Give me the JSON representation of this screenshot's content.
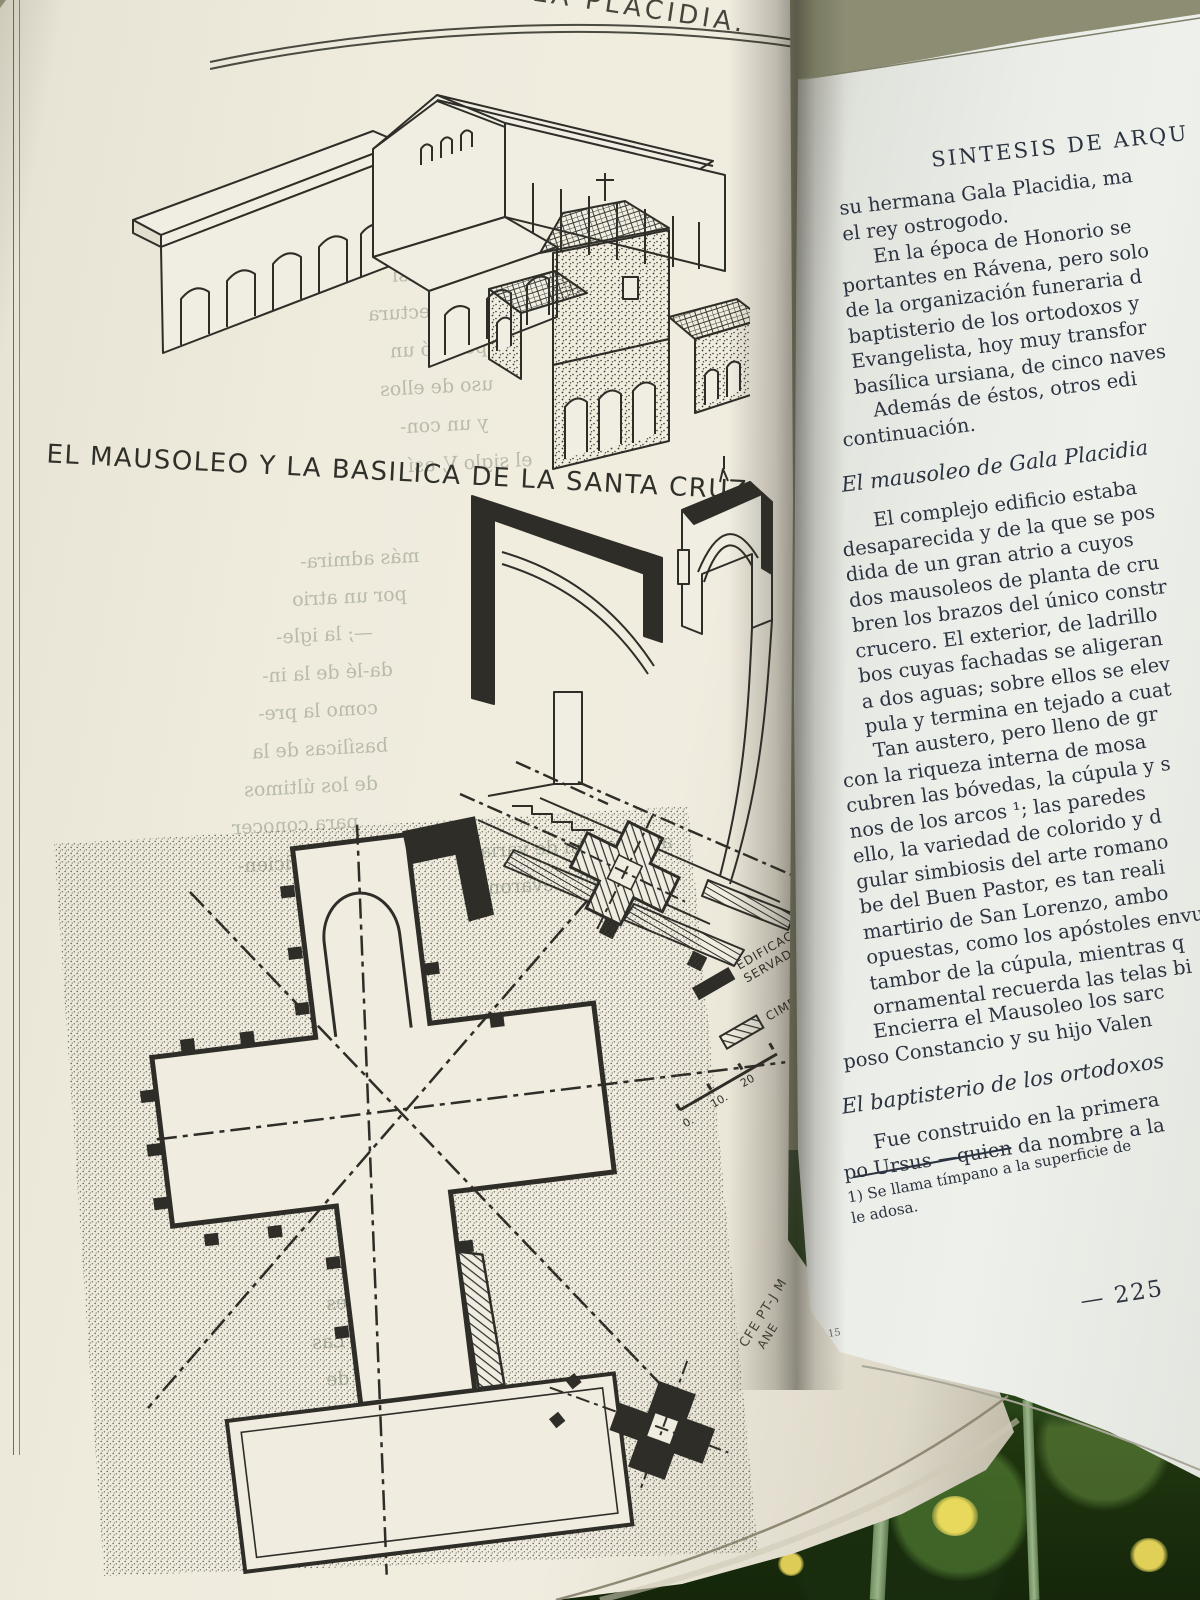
{
  "palette": {
    "left_paper": "#eee9dc",
    "right_paper": "#e9ebe6",
    "ink_text": "#2c3340",
    "ink_drawing": "#2e2d28",
    "grass_dark": "#21380f",
    "grass_light": "#5f8f3c",
    "flower_yellow": "#e3d352",
    "background_olive": "#8c8d72"
  },
  "left_page": {
    "running_head_fragment": "GALA PLACIDIA.",
    "caption": "EL MAUSOLEO Y LA BASILICA DE LA SANTA CRUZ.",
    "legend_items": [
      {
        "swatch": "solid-black",
        "lines": [
          "EDIFICACIONES",
          "SERVADAS"
        ]
      },
      {
        "swatch": "hatched",
        "lines": [
          "CIMENTACIONES"
        ]
      }
    ],
    "scale_labels": [
      "0.",
      "10.",
      "20"
    ],
    "plan_note_lines": [
      "CFE PT-J M",
      "ANE"
    ],
    "showthrough_fragments": [
      "ciudad casi",
      "la arquitectura",
      "poseyó un",
      "uso de ellos",
      "y un con-",
      "el siglo V, así",
      "más admira-",
      "por un atrio",
      "—; la igle-",
      "da-lé de la in-",
      "como la pre-",
      "basílicas de la",
      "de los últimos",
      "para conocer",
      "itud suficien-",
      "agrupación de varias",
      "allí llevaron",
      "unificador",
      "cinturón de murallas a",
      "undados y",
      "Honorio (3",
      "de Oriente",
      "ciudades",
      "urbana. Las",
      "taron, de"
    ]
  },
  "right_page": {
    "blocks": [
      {
        "type": "header",
        "lines": [
          "SINTESIS DE ARQU"
        ]
      },
      {
        "type": "para",
        "indent": false,
        "lines": [
          "su hermana Gala Placidia, ma",
          "el rey ostrogodo."
        ]
      },
      {
        "type": "para",
        "indent": true,
        "lines": [
          "En la época de Honorio se",
          "portantes en Rávena, pero solo",
          "de la organización funeraria d",
          "baptisterio de los ortodoxos y",
          "Evangelista, hoy muy transfor",
          "basílica ursiana, de cinco naves"
        ]
      },
      {
        "type": "para",
        "indent": true,
        "lines": [
          "Además de éstos, otros edi",
          "continuación."
        ]
      },
      {
        "type": "heading",
        "lines": [
          "El mausoleo de Gala Placidia"
        ]
      },
      {
        "type": "para",
        "indent": true,
        "lines": [
          "El complejo edificio estaba",
          "desaparecida y de la que se pos",
          "dida de un gran atrio a cuyos",
          "dos mausoleos de planta de cru",
          "bren los brazos del único constr",
          "crucero. El exterior, de ladrillo",
          "bos cuyas fachadas se aligeran",
          "a dos aguas; sobre ellos se elev",
          "pula y termina en tejado a cuat"
        ]
      },
      {
        "type": "para",
        "indent": true,
        "lines": [
          "Tan austero, pero lleno de gr",
          "con la riqueza interna de mosa",
          "cubren las bóvedas, la cúpula y s",
          "nos de los arcos ¹;  las paredes",
          "ello, la variedad de colorido y d",
          "gular simbiosis del arte romano",
          "be del Buen Pastor, es tan reali",
          "martirio de San Lorenzo, ambo",
          "opuestas, como los apóstoles envu",
          "tambor de la cúpula, mientras q",
          "ornamental recuerda las telas bi"
        ]
      },
      {
        "type": "para",
        "indent": true,
        "lines": [
          "Encierra el Mausoleo los sarc",
          "poso Constancio y su hijo Valen"
        ]
      },
      {
        "type": "heading",
        "lines": [
          "El baptisterio de los ortodoxos"
        ]
      },
      {
        "type": "para",
        "indent": true,
        "lines": [
          "Fue construido en la primera",
          "po Ursus —quien da nombre a la"
        ]
      }
    ],
    "footnote": {
      "lines": [
        "1)  Se llama tímpano a la superficie de",
        "le adosa."
      ]
    },
    "page_number": "— 225",
    "signature_mark": "15"
  }
}
